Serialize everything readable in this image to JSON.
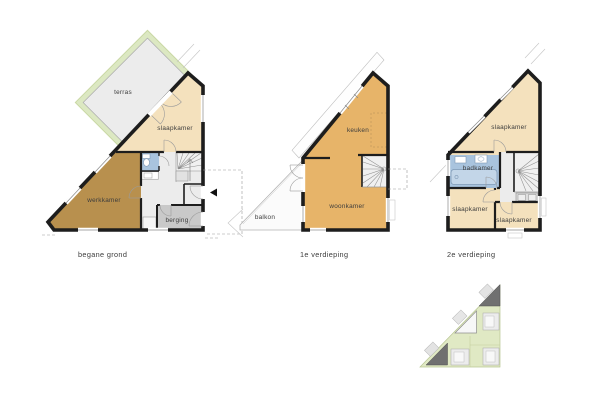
{
  "page": {
    "background": "#ffffff"
  },
  "colors": {
    "wall": "#1d1d1d",
    "bedroom_fill": "#f4e1bd",
    "living_fill": "#e7b469",
    "work_fill": "#b8904e",
    "bath_fill": "#a9c4de",
    "hall_fill": "#ececec",
    "storage_fill": "#c9c9c9",
    "stair_fill": "#f0f0f0",
    "hedge_fill": "#dce8c2",
    "terrace_fill": "#ececec",
    "balcony_fill": "#fbfbfb",
    "site_green": "#e0e9c4",
    "site_house_dark": "#707070",
    "site_house_light": "#f7f7f7",
    "label_color": "#3c3c3c"
  },
  "floors": [
    {
      "id": "begane-grond",
      "title": "begane grond",
      "rooms": [
        {
          "id": "terras",
          "label": "terras"
        },
        {
          "id": "slaapkamer",
          "label": "slaapkamer"
        },
        {
          "id": "werkkamer",
          "label": "werkkamer"
        },
        {
          "id": "berging",
          "label": "berging"
        }
      ]
    },
    {
      "id": "1e-verdieping",
      "title": "1e verdieping",
      "rooms": [
        {
          "id": "balkon",
          "label": "balkon"
        },
        {
          "id": "keuken",
          "label": "keuken"
        },
        {
          "id": "woonkamer",
          "label": "woonkamer"
        }
      ]
    },
    {
      "id": "2e-verdieping",
      "title": "2e verdieping",
      "rooms": [
        {
          "id": "slaapkamer-boven",
          "label": "slaapkamer"
        },
        {
          "id": "badkamer",
          "label": "badkamer"
        },
        {
          "id": "slaapkamer-links",
          "label": "slaapkamer"
        },
        {
          "id": "slaapkamer-rechts",
          "label": "slaapkamer"
        }
      ]
    }
  ]
}
